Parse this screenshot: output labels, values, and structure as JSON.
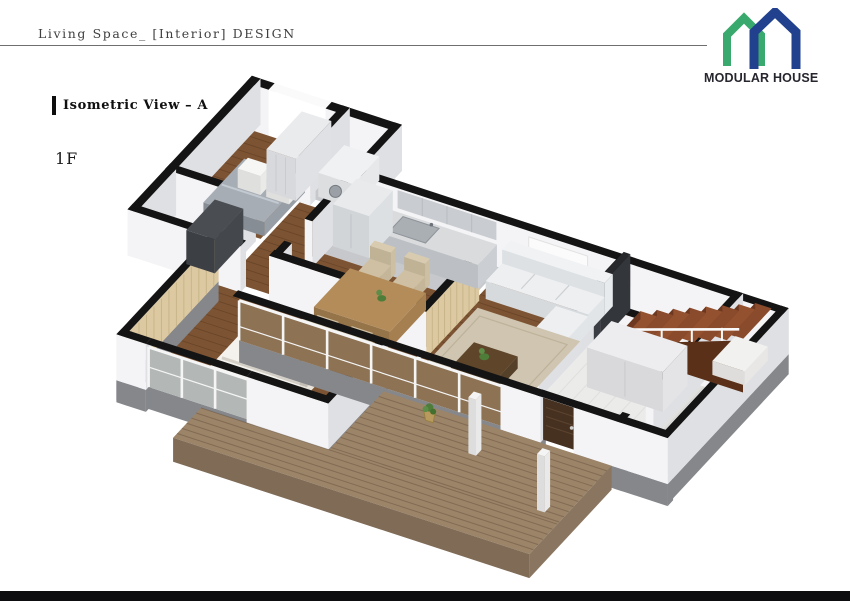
{
  "header": {
    "title": "Living Space_ [Interior] DESIGN"
  },
  "logo": {
    "brand": "MODULAR HOUSE",
    "green": "#3aa96d",
    "navy": "#21418e",
    "icons": [
      "green-house-icon",
      "navy-house-icon"
    ]
  },
  "view": {
    "label": "Isometric View – A",
    "floor": "1F"
  },
  "footer": {
    "bar_color": "#0d0d10"
  },
  "palette": {
    "cap": "#141414",
    "wallFace": "#f4f4f6",
    "wallSide": "#dfe0e4",
    "base": "#85878b",
    "wood": "#7d5433",
    "woodDark": "#6f4a2b",
    "woodLine": "rgba(62,36,16,0.30)",
    "tile": "#c6c8cb",
    "tileDark": "#9ba0a5",
    "entryTile": "#ebebe9",
    "porchTile": "#e0e1df",
    "bathTile": "#8f9398",
    "deck": "#9c8469",
    "deckLine": "rgba(80,60,40,0.35)",
    "deckSide": "#7f6b56",
    "deckSideE": "#8a7660",
    "rug": "#cfc5b0",
    "rugLine": "#bdb29a",
    "slat": "#dcc9a2",
    "slatLine": "#c8b589",
    "stair": "#8a4a2c",
    "stairAlt": "#93512f",
    "stairRiser": "#6d381f",
    "stairSide": "#5a3018",
    "sofa": "#edeff1",
    "counter": "#d9dbdd",
    "glassWood": "#8d7254",
    "glassCool": "#b3b8b6",
    "door": "#46301f",
    "dark": "#3a3d43",
    "darkTop": "#26282c",
    "table": "#b48c5a",
    "chair": "#cfc0a4",
    "plant": "#4e7d3a",
    "bedGray": "#a7adb5",
    "furnWhite": "#ededef",
    "rail": "#fafafa",
    "mullion": "#f5f5f5"
  }
}
